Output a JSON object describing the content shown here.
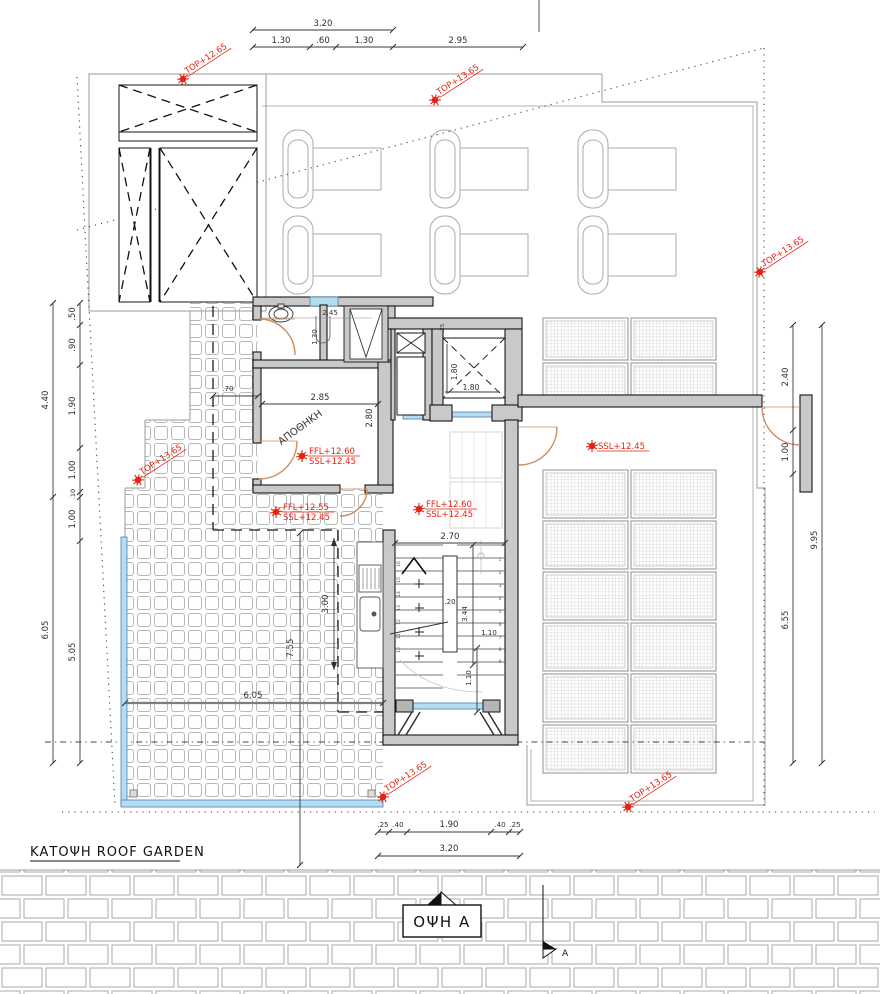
{
  "meta": {
    "plan_title": "ΚΑΤΟΨΗ  ROOF GARDEN",
    "elevation_label": "ΟΨΗ Α",
    "section_letter": "A",
    "storage_room_label": "ΑΠΟΘΗΚΗ"
  },
  "colors": {
    "marker_red": "#e42313",
    "door_orange": "#cf8a5a",
    "glass_blue": "#b5ddf1",
    "glass_stroke": "#4f7fae",
    "wall_fill": "#c9c9c9",
    "line_dark": "#141414",
    "line_gray": "#9b9b9b",
    "dim_color": "#2e2e2e"
  },
  "levels": [
    {
      "label": "TOP+12.65",
      "x": 183,
      "y": 79,
      "rot": -33
    },
    {
      "label": "TOP+13.65",
      "x": 435,
      "y": 100,
      "rot": -33
    },
    {
      "label": "TOP+13.65",
      "x": 760,
      "y": 272,
      "rot": -33
    },
    {
      "label": "TOP+13.65",
      "x": 138,
      "y": 480,
      "rot": -33
    },
    {
      "label": "TOP+13.65",
      "x": 383,
      "y": 797,
      "rot": -33
    },
    {
      "label": "TOP+13.65",
      "x": 628,
      "y": 807,
      "rot": -33
    },
    {
      "label": "SSL+12.45",
      "x": 592,
      "y": 446,
      "rot": 0
    }
  ],
  "levels2": [
    {
      "l1": "FFL+12.60",
      "l2": "SSL+12.45",
      "x": 302,
      "y": 452
    },
    {
      "l1": "FFL+12.55",
      "l2": "SSL+12.45",
      "x": 276,
      "y": 508
    },
    {
      "l1": "FFL+12.60",
      "l2": "SSL+12.45",
      "x": 419,
      "y": 505
    }
  ],
  "texts": [
    {
      "t": "3.20",
      "x": 323,
      "y": 26
    },
    {
      "t": "1.30",
      "x": 281,
      "y": 43
    },
    {
      "t": ".60",
      "x": 323,
      "y": 43
    },
    {
      "t": "1.30",
      "x": 364,
      "y": 43
    },
    {
      "t": "2.95",
      "x": 458,
      "y": 43
    },
    {
      "t": "4.40",
      "x": 48,
      "y": 400,
      "r": -90
    },
    {
      "t": "6.05",
      "x": 48,
      "y": 630,
      "r": -90
    },
    {
      "t": ".50",
      "x": 75,
      "y": 314,
      "r": -90
    },
    {
      "t": ".90",
      "x": 75,
      "y": 345,
      "r": -90
    },
    {
      "t": "1.90",
      "x": 75,
      "y": 406,
      "r": -90
    },
    {
      "t": "1.00",
      "x": 75,
      "y": 470,
      "r": -90
    },
    {
      "t": ".10",
      "x": 75,
      "y": 494,
      "r": -90,
      "s": 6.5
    },
    {
      "t": "1.00",
      "x": 75,
      "y": 519,
      "r": -90
    },
    {
      "t": "5.05",
      "x": 75,
      "y": 652,
      "r": -90
    },
    {
      "t": "2.40",
      "x": 788,
      "y": 377,
      "r": -90
    },
    {
      "t": "1.00",
      "x": 788,
      "y": 452,
      "r": -90
    },
    {
      "t": "6.55",
      "x": 788,
      "y": 620,
      "r": -90
    },
    {
      "t": "9.95",
      "x": 817,
      "y": 540,
      "r": -90
    },
    {
      "t": "2.85",
      "x": 320,
      "y": 400
    },
    {
      "t": "2.80",
      "x": 372,
      "y": 418,
      "r": -90
    },
    {
      "t": ".70",
      "x": 228,
      "y": 391,
      "s": 7
    },
    {
      "t": "2.45",
      "x": 330,
      "y": 315,
      "s": 7
    },
    {
      "t": "1.30",
      "x": 317,
      "y": 337,
      "r": -90,
      "s": 7
    },
    {
      "t": "1.80",
      "x": 457,
      "y": 372,
      "r": -90,
      "s": 7.5
    },
    {
      "t": "1.80",
      "x": 471,
      "y": 390,
      "s": 7.5
    },
    {
      "t": ".25",
      "x": 444,
      "y": 328,
      "r": -90,
      "s": 5.5
    },
    {
      "t": "2.70",
      "x": 450,
      "y": 539
    },
    {
      "t": ".20",
      "x": 450,
      "y": 604,
      "s": 7
    },
    {
      "t": "3.44",
      "x": 467,
      "y": 614,
      "r": -90,
      "s": 7
    },
    {
      "t": "1.10",
      "x": 489,
      "y": 635,
      "s": 7
    },
    {
      "t": "1.10",
      "x": 471,
      "y": 678,
      "r": -90,
      "s": 7
    },
    {
      "t": "3.00",
      "x": 328,
      "y": 604,
      "r": -90
    },
    {
      "t": "7.55",
      "x": 293,
      "y": 648,
      "r": -90
    },
    {
      "t": "6.05",
      "x": 253,
      "y": 698
    },
    {
      "t": ".25",
      "x": 383,
      "y": 827,
      "s": 7
    },
    {
      "t": ".40",
      "x": 398,
      "y": 827,
      "s": 7
    },
    {
      "t": "1.90",
      "x": 449,
      "y": 827
    },
    {
      "t": ".40",
      "x": 500,
      "y": 827,
      "s": 7
    },
    {
      "t": ".25",
      "x": 515,
      "y": 827,
      "s": 7
    },
    {
      "t": "3.20",
      "x": 449,
      "y": 851
    },
    {
      "t": "ΑΠΟΘΗΚΗ",
      "x": 302,
      "y": 430,
      "r": -36,
      "s": 10,
      "c": "#333",
      "n": "room-label-storage"
    },
    {
      "t": "1",
      "x": 500,
      "y": 561,
      "s": 4.5,
      "c": "#555",
      "n": "stair-number"
    },
    {
      "t": "2",
      "x": 500,
      "y": 574,
      "s": 4.5,
      "c": "#555",
      "n": "stair-number"
    },
    {
      "t": "3",
      "x": 500,
      "y": 587,
      "s": 4.5,
      "c": "#555",
      "n": "stair-number"
    },
    {
      "t": "4",
      "x": 500,
      "y": 600,
      "s": 4.5,
      "c": "#555",
      "n": "stair-number"
    },
    {
      "t": "5",
      "x": 500,
      "y": 613,
      "s": 4.5,
      "c": "#555",
      "n": "stair-number"
    },
    {
      "t": "6",
      "x": 500,
      "y": 626,
      "s": 4.5,
      "c": "#555",
      "n": "stair-number"
    },
    {
      "t": "7",
      "x": 500,
      "y": 639,
      "s": 4.5,
      "c": "#555",
      "n": "stair-number"
    },
    {
      "t": "8",
      "x": 500,
      "y": 651,
      "s": 4.5,
      "c": "#555",
      "n": "stair-number"
    },
    {
      "t": "9",
      "x": 500,
      "y": 663,
      "s": 4.5,
      "c": "#555",
      "n": "stair-number"
    },
    {
      "t": "10",
      "x": 400,
      "y": 650,
      "r": -90,
      "s": 4.5,
      "c": "#555",
      "n": "stair-number"
    },
    {
      "t": "11",
      "x": 400,
      "y": 636,
      "r": -90,
      "s": 4.5,
      "c": "#555",
      "n": "stair-number"
    },
    {
      "t": "12",
      "x": 400,
      "y": 622,
      "r": -90,
      "s": 4.5,
      "c": "#555",
      "n": "stair-number"
    },
    {
      "t": "13",
      "x": 400,
      "y": 608,
      "r": -90,
      "s": 4.5,
      "c": "#555",
      "n": "stair-number"
    },
    {
      "t": "14",
      "x": 400,
      "y": 594,
      "r": -90,
      "s": 4.5,
      "c": "#555",
      "n": "stair-number"
    },
    {
      "t": "15",
      "x": 400,
      "y": 580,
      "r": -90,
      "s": 4.5,
      "c": "#555",
      "n": "stair-number"
    },
    {
      "t": "16",
      "x": 400,
      "y": 564,
      "r": -90,
      "s": 4.5,
      "c": "#555",
      "n": "stair-number"
    }
  ]
}
